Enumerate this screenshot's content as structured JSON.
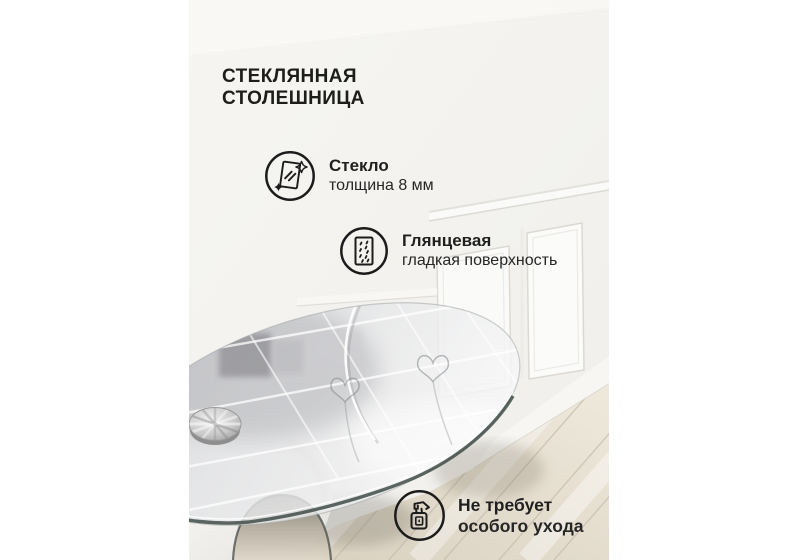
{
  "heading": {
    "line1": "СТЕКЛЯННАЯ",
    "line2": "СТОЛЕШНИЦА"
  },
  "features": [
    {
      "id": "glass",
      "icon": "glass-pane-sparkle-icon",
      "title": "Стекло",
      "subtitle": "толщина 8 мм"
    },
    {
      "id": "glossy",
      "icon": "glossy-surface-icon",
      "title": "Глянцевая",
      "subtitle": "гладкая поверхность"
    },
    {
      "id": "care",
      "icon": "spray-bottle-icon",
      "title": "Не требует",
      "subtitle": "особого ухода"
    }
  ],
  "colors": {
    "canvas_background": "#ffffff",
    "text": "#1d1d1b",
    "icon_stroke": "#1c1c1c",
    "wall": "#f4f3ef",
    "wainscoting_line": "#dcd9d3",
    "wood_floor": "#e0d8c8",
    "glass_edge": "#3f4c48",
    "chrome_disc": "#b9b9b9",
    "table_base": "#f7f6f3"
  }
}
